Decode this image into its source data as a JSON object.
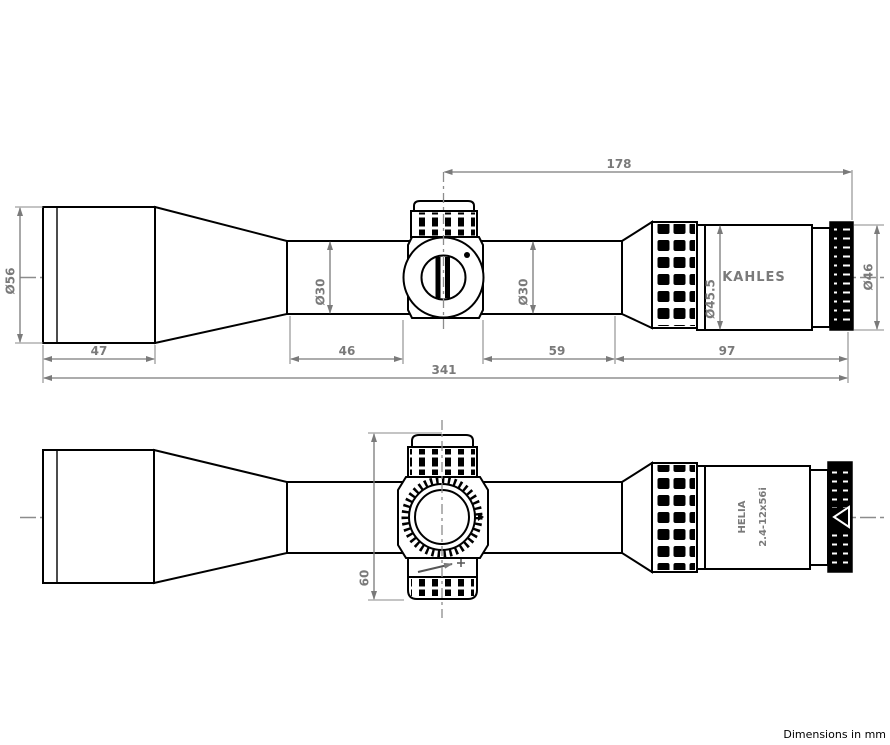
{
  "title": "Riflescope dimensional drawing",
  "footer": {
    "note": "Dimensions in mm"
  },
  "colors": {
    "outline": "#000000",
    "dimension": "#7a7a7a",
    "centerline": "#8c8c8c",
    "background": "#ffffff"
  },
  "top_view": {
    "name": "side-view",
    "brand": "KAHLES",
    "dims": {
      "objective_diameter": "Ø56",
      "objective_length": "47",
      "front_tube_length": "46",
      "rear_tube_length": "59",
      "eyepiece_length": "97",
      "overall_length": "341",
      "turret_to_end": "178",
      "tube_diameter_front": "Ø30",
      "tube_diameter_rear": "Ø30",
      "eyepiece_diameter": "Ø45.5",
      "end_diameter": "Ø46"
    }
  },
  "bottom_view": {
    "name": "top-view",
    "model": "HELIA",
    "spec": "2.4-12x56i",
    "dims": {
      "turret_height": "60"
    }
  }
}
